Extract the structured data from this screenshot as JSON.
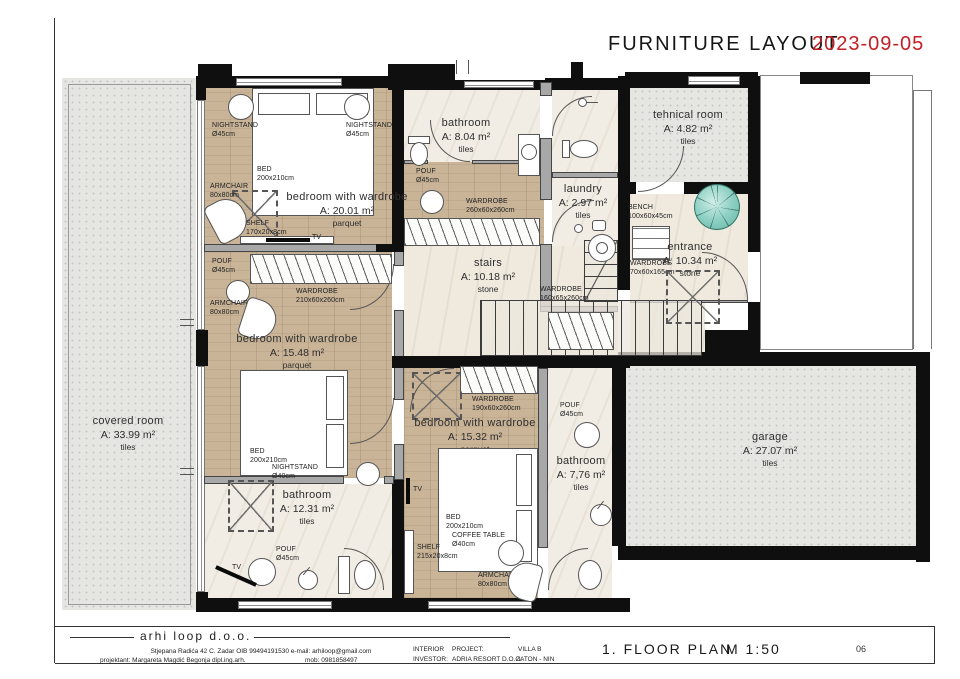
{
  "header": {
    "title": "FURNITURE LAYOUT",
    "date": "2023-09-05"
  },
  "colors": {
    "date_red": "#c32026",
    "wall": "#0f0f0f",
    "parquet": "#c9b497",
    "marble": "#f2ede4",
    "speckle": "#e5e5e2",
    "plant_teal": "#8fd0c4"
  },
  "rooms": {
    "bedroom1": {
      "name": "bedroom with wardrobe",
      "area": "A: 20.01 m²",
      "floor": "parquet"
    },
    "bathroom1": {
      "name": "bathroom",
      "area": "A: 8.04 m²",
      "floor": "tiles"
    },
    "laundry": {
      "name": "laundry",
      "area": "A: 2.97 m²",
      "floor": "tiles"
    },
    "technical": {
      "name": "tehnical room",
      "area": "A: 4.82 m²",
      "floor": "tiles"
    },
    "entrance": {
      "name": "entrance",
      "area": "A: 10.34 m²",
      "floor": "stone"
    },
    "stairs": {
      "name": "stairs",
      "area": "A: 10.18 m²",
      "floor": "stone"
    },
    "bedroom2": {
      "name": "bedroom with wardrobe",
      "area": "A: 15.48 m²",
      "floor": "parquet"
    },
    "bathroom2": {
      "name": "bathroom",
      "area": "A: 12.31 m²",
      "floor": "tiles"
    },
    "bedroom3": {
      "name": "bedroom with wardrobe",
      "area": "A: 15.32 m²",
      "floor": "parquet"
    },
    "bathroom3": {
      "name": "bathroom",
      "area": "A: 7,76 m²",
      "floor": "tiles"
    },
    "covered": {
      "name": "covered room",
      "area": "A: 33.99 m²",
      "floor": "tiles"
    },
    "garage": {
      "name": "garage",
      "area": "A: 27.07 m²",
      "floor": "tiles"
    }
  },
  "furniture": {
    "nightstand45": {
      "name": "NIGHTSTAND",
      "size": "Ø45cm"
    },
    "bed": {
      "name": "BED",
      "size": "200x210cm"
    },
    "armchair": {
      "name": "ARMCHAIR",
      "size": "80x80cm"
    },
    "shelf1": {
      "name": "SHELF",
      "size": "170x20x8cm"
    },
    "tv": {
      "name": "TV"
    },
    "pouf45": {
      "name": "POUF",
      "size": "Ø45cm"
    },
    "wardrobe260": {
      "name": "WARDROBE",
      "size": "260x60x260cm"
    },
    "wardrobe160": {
      "name": "WARDROBE",
      "size": "160x65x260cm"
    },
    "bench": {
      "name": "BENCH",
      "size": "100x60x45cm"
    },
    "wardrobe70": {
      "name": "WARDROBE",
      "size": "70x60x165cm"
    },
    "wardrobe210": {
      "name": "WARDROBE",
      "size": "210x60x260cm"
    },
    "nightstand40": {
      "name": "NIGHTSTAND",
      "size": "Ø40cm"
    },
    "wardrobe190": {
      "name": "WARDROBE",
      "size": "190x60x260cm"
    },
    "shelf2": {
      "name": "SHELF",
      "size": "215x20x8cm"
    },
    "coffee_table": {
      "name": "COFFEE TABLE",
      "size": "Ø40cm"
    }
  },
  "footer": {
    "company": "arhi loop   d.o.o.",
    "address": "Stjepana Radića 42 C. Zadar    OIB 99494191530    e-mail: arhiloop@gmail.com",
    "designer": "projektant: Margareta Magdić Begonja  dipl.ing.arh.",
    "mobile": "mob: 0981858497",
    "interior_label": "INTERIOR",
    "project_label": "PROJECT:",
    "project_value": "VILLA   B",
    "investor_label": "INVESTOR:",
    "investor_value": "ADRIA RESORT D.O.O.",
    "location": "ZATON - NIN",
    "plan_title": "1.  FLOOR  PLAN",
    "scale": "M 1:50",
    "page": "06"
  }
}
